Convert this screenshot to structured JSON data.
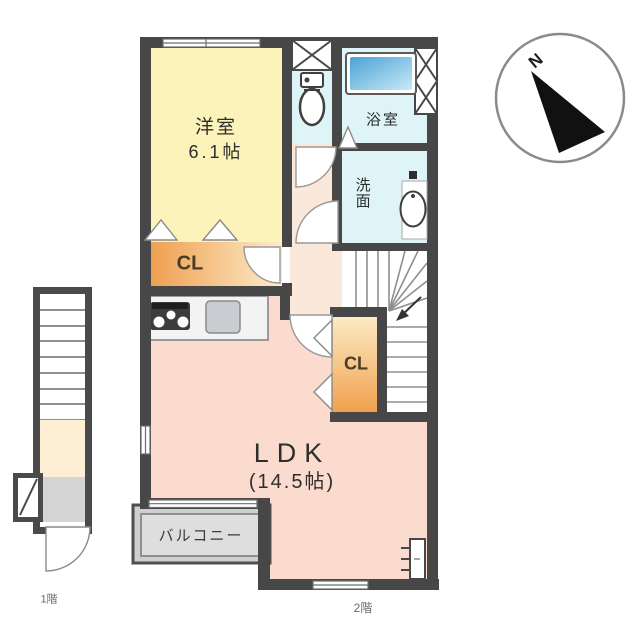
{
  "plan": {
    "rooms": {
      "western_room": {
        "name": "洋室",
        "size": "6.1帖"
      },
      "bath": {
        "name": "浴室"
      },
      "washroom": {
        "name": "洗面"
      },
      "closet1": {
        "label": "CL"
      },
      "closet2": {
        "label": "CL"
      },
      "ldk": {
        "name": "LDK",
        "size": "(14.5帖)"
      },
      "balcony": {
        "name": "バルコニー"
      }
    },
    "floor_labels": {
      "first_floor": "1階",
      "second_floor": "2階"
    },
    "compass": {
      "north": "N"
    },
    "colors": {
      "wall": "#474747",
      "western_room": "#fbf3ba",
      "wet_area": "#def4f7",
      "hall": "#fae8db",
      "ldk": "#fadbce",
      "closet_deep": "#f0a557",
      "closet_light": "#fdeccb",
      "bathtub": "#55abdc",
      "bathtub_light": "#c9e9f6",
      "balcony": "#dedede"
    }
  }
}
